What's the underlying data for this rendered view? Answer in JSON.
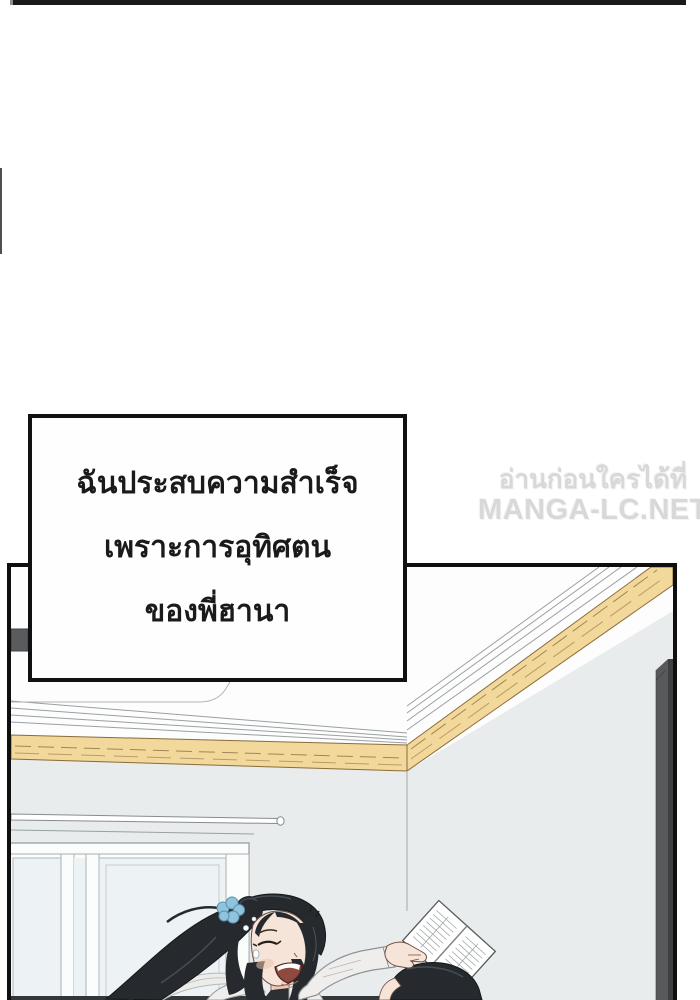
{
  "speech_bubble": {
    "lines": [
      "ฉันประสบความสำเร็จ",
      "เพราะการอุทิศตน",
      "ของพี่ฮานา"
    ]
  },
  "watermark": {
    "line1": "อ่านก่อนใครได้ที่",
    "line2": "MANGA-LC.NET"
  },
  "colors": {
    "page_bg": "#ffffff",
    "bar": "#1a1a1a",
    "edge_mark": "#4f4f4f",
    "panel_border": "#0f0f0f",
    "bubble_border": "#111111",
    "bubble_bg": "#fefefe",
    "bubble_text": "#1a1a1a",
    "watermark": "#d6d6d6",
    "ceiling": "#fdfdfe",
    "wall": "#e8eced",
    "line": "#9aa0a2",
    "trim": "#f3d89b",
    "trim_line": "#8a6b3a",
    "door": "#57595b",
    "door_edge": "#3d4042",
    "window_frame": "#fbfcfc",
    "pane": "#edf3f5",
    "hair": "#262a2e",
    "hair_hi": "#454e55",
    "skin": "#f7e4d8",
    "skin_line": "#6e4c40",
    "skin_shadow": "#e9c2ad",
    "scrunchie": "#8fc3de",
    "scrunchie_line": "#5e93ad",
    "cloth": "#efeeec",
    "cloth_line": "#b5b8b9",
    "paper": "#ffffff",
    "paper_line": "#9aa0a2",
    "paper_edge": "#555a5c",
    "mouth": "#8e4a3e",
    "teeth": "#ffffff",
    "collar": "#2d3033",
    "strip": "#34373a"
  }
}
